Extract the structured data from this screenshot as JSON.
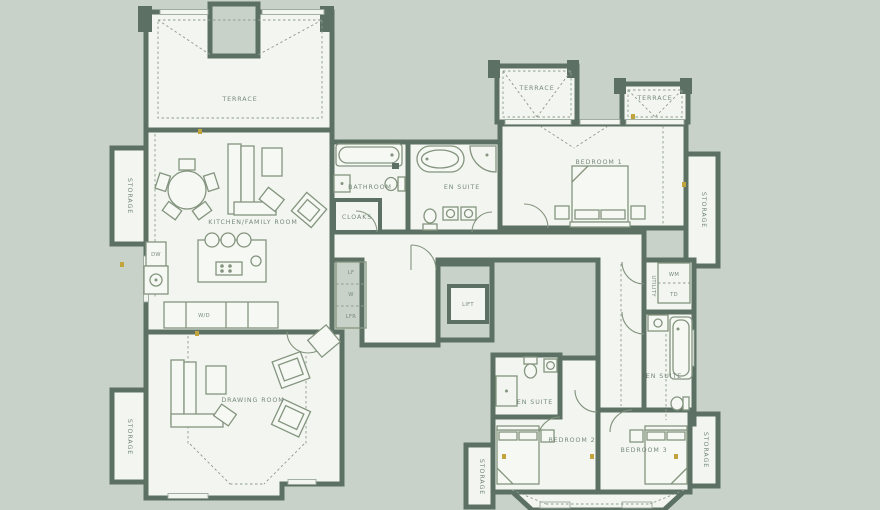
{
  "colors": {
    "background": "#c9d2c8",
    "wall": "#5c7164",
    "floor": "#f3f6f0",
    "furniture_line": "#84947f",
    "label_text": "#76897b",
    "marker": "#c2a43d"
  },
  "rooms": {
    "terrace_tl": "TERRACE",
    "terrace_mid": "TERRACE",
    "terrace_right": "TERRACE",
    "storage_left_upper": "STORAGE",
    "kitchen_family": "KITCHEN/FAMILY ROOM",
    "bathroom": "BATHROOM",
    "cloaks": "CLOAKS",
    "ensuite_master": "EN SUITE",
    "bedroom1": "BEDROOM 1",
    "storage_right_upper": "STORAGE",
    "cupboard_lf": "LF",
    "cupboard_w": "W",
    "cupboard_lfr": "LFR",
    "lift": "LIFT",
    "utility": "UTILITY",
    "wm": "WM",
    "td": "TD",
    "dw": "DW",
    "wd": "W/D",
    "drawing_room": "DRAWING ROOM",
    "storage_left_lower": "STORAGE",
    "ensuite_bed2": "EN SUITE",
    "ensuite_bed3": "EN SUITE",
    "bedroom2": "BEDROOM 2",
    "bedroom3": "BEDROOM 3",
    "storage_bottom_center": "STORAGE",
    "storage_bottom_right": "STORAGE"
  }
}
